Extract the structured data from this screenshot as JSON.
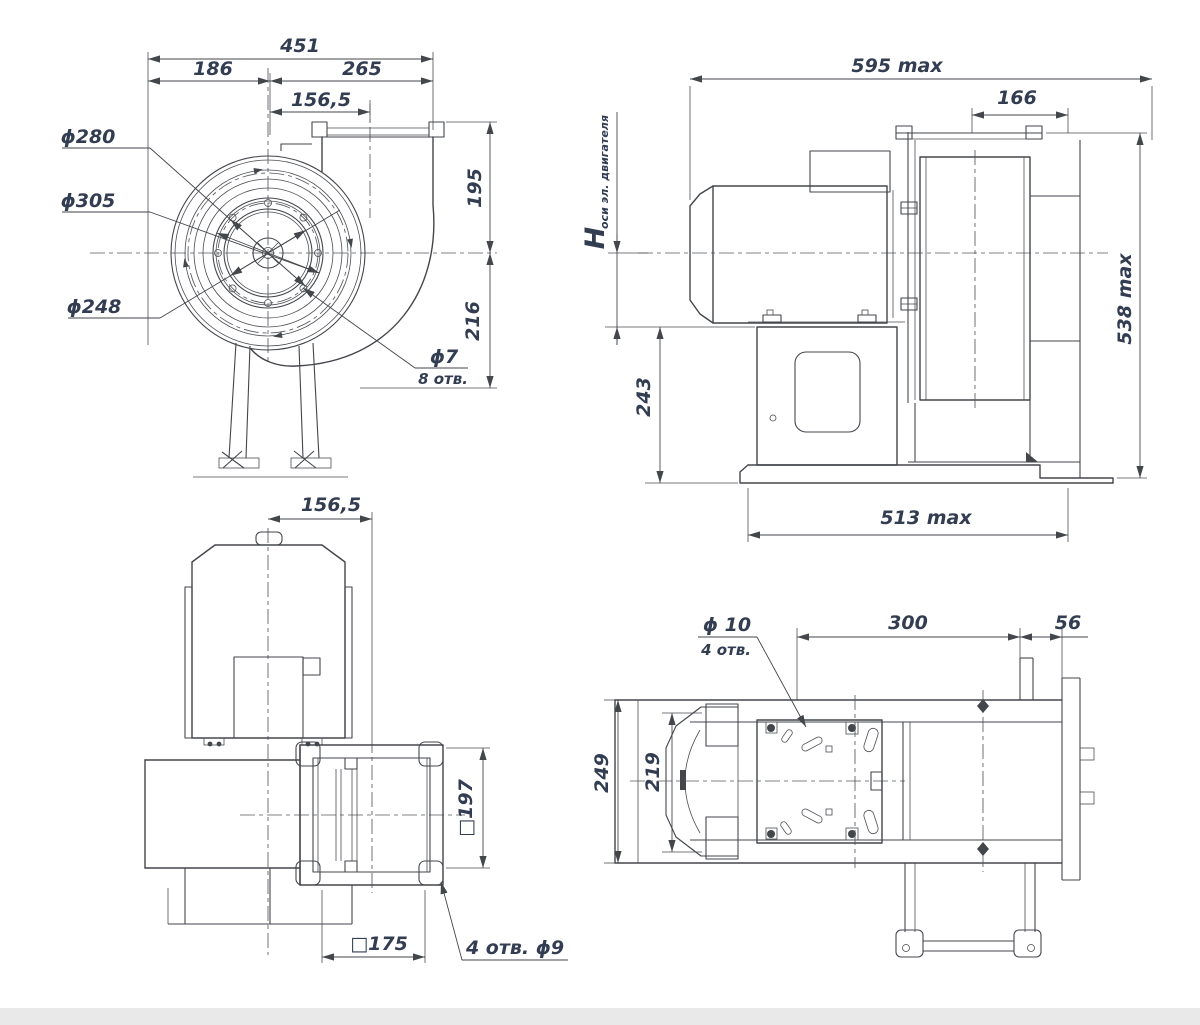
{
  "page": {
    "background_color": "#ffffff",
    "line_color": "#43464b",
    "dimension_text_color": "#333d52"
  },
  "labels": {
    "front": {
      "total_width": "451",
      "left_width": "186",
      "right_width": "265",
      "outlet_offset": "156,5",
      "dia_280": "ϕ280",
      "dia_305": "ϕ305",
      "dia_248": "ϕ248",
      "height_top": "195",
      "height_bottom": "216",
      "holes_dia": "ϕ7",
      "holes_count": "8 отв."
    },
    "side": {
      "length_max": "595 max",
      "inlet_width": "166",
      "axis_height_symbol": "H",
      "axis_height_note": "оси эл. двигателя",
      "pedestal_height": "243",
      "height_max": "538 max",
      "base_length_max": "513 max"
    },
    "top": {
      "outlet_offset": "156,5",
      "flange_outer": "□197",
      "flange_inner": "□175",
      "flange_holes": "4 отв.  ϕ9"
    },
    "plan": {
      "holes_dia": "ϕ 10",
      "holes_count": "4 отв.",
      "length_300": "300",
      "length_56": "56",
      "width_249": "249",
      "width_219": "219"
    }
  }
}
